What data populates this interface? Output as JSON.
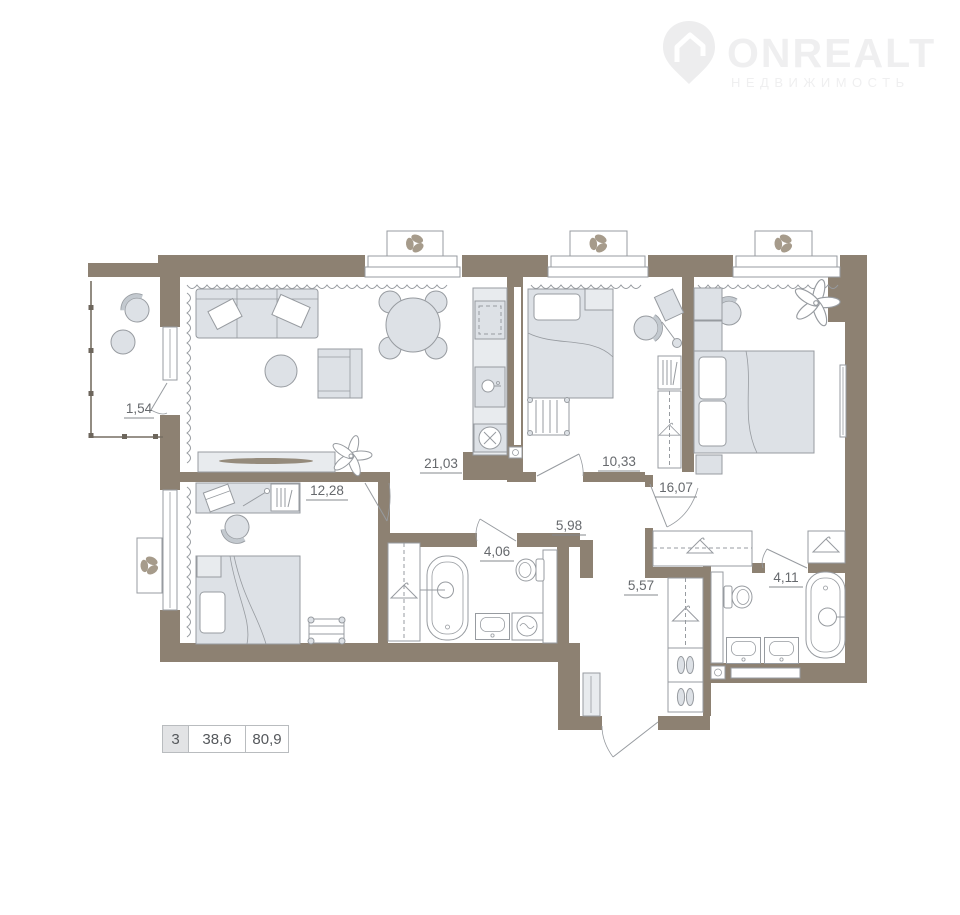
{
  "logo": {
    "brand": "ONREALT",
    "tagline": "НЕДВИЖИМОСТЬ"
  },
  "summary": {
    "rooms_count": "3",
    "living_area": "38,6",
    "total_area": "80,9"
  },
  "plan": {
    "rooms": [
      {
        "name": "balcony",
        "area": "1,54"
      },
      {
        "name": "living-room-kitchen",
        "area": "21,03"
      },
      {
        "name": "bedroom-middle",
        "area": "10,33"
      },
      {
        "name": "bedroom-master",
        "area": "16,07"
      },
      {
        "name": "bedroom-left",
        "area": "12,28"
      },
      {
        "name": "hallway",
        "area": "5,98"
      },
      {
        "name": "bathroom",
        "area": "4,06"
      },
      {
        "name": "corridor",
        "area": "5,57"
      },
      {
        "name": "bathroom-master",
        "area": "4,11"
      }
    ]
  },
  "colors": {
    "wall": "#8d8172",
    "furniture": "#dde1e6",
    "outline": "#979ba0",
    "label_text": "#66696d",
    "logo_watermark": "#efeff0"
  }
}
